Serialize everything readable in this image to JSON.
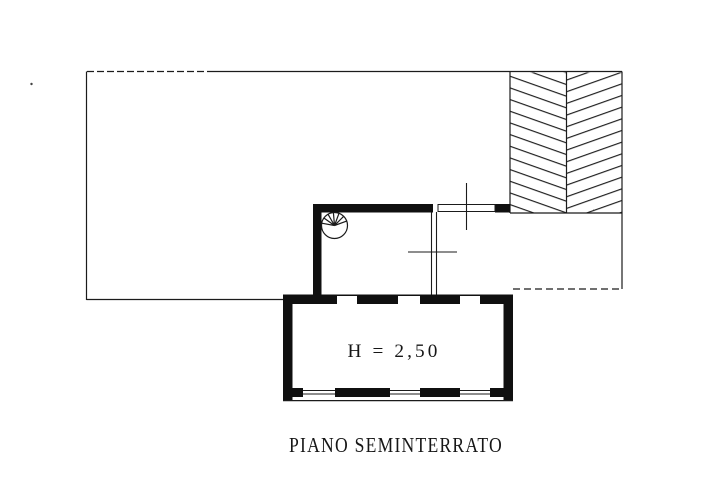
{
  "colors": {
    "ink": "#1b1b1b",
    "wall": "#101010",
    "background": "#ffffff"
  },
  "plan": {
    "caption": "PIANO SEMINTERRATO",
    "room_height_label": "H = 2,50"
  }
}
